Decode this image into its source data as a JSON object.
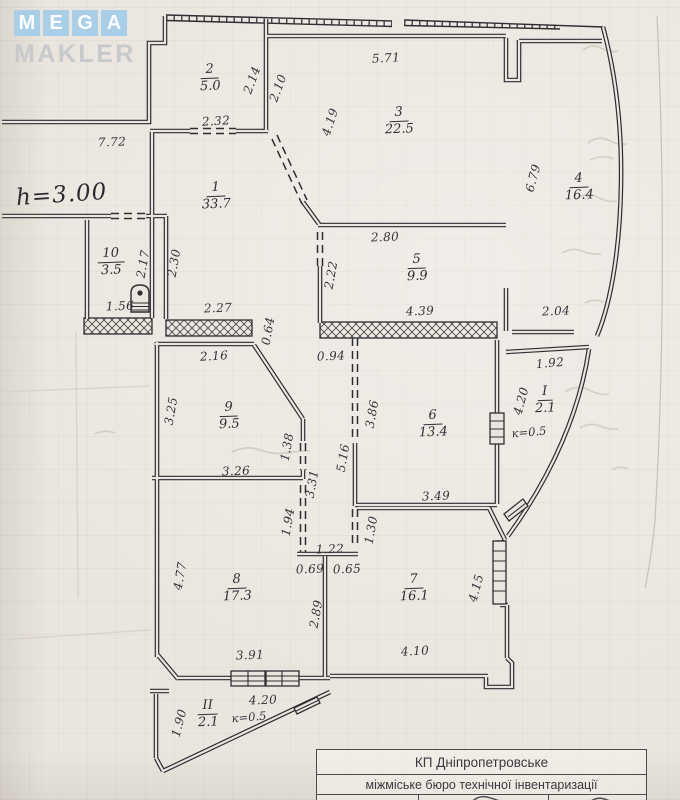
{
  "watermark": {
    "letters": [
      "M",
      "E",
      "G",
      "A"
    ],
    "subtitle": "MAKLER"
  },
  "notes": {
    "ceiling_height": "h=3.00"
  },
  "rooms": [
    {
      "number": "1",
      "area": "33.7"
    },
    {
      "number": "2",
      "area": "5.0"
    },
    {
      "number": "3",
      "area": "22.5"
    },
    {
      "number": "4",
      "area": "16.4"
    },
    {
      "number": "5",
      "area": "9.9"
    },
    {
      "number": "6",
      "area": "13.4"
    },
    {
      "number": "7",
      "area": "16.1"
    },
    {
      "number": "8",
      "area": "17.3"
    },
    {
      "number": "9",
      "area": "9.5"
    },
    {
      "number": "10",
      "area": "3.5"
    },
    {
      "number": "І",
      "area": "2.1",
      "coef": "к=0.5"
    },
    {
      "number": "ІІ",
      "area": "2.1",
      "coef": "к=0.5"
    }
  ],
  "dims": [
    "7.72",
    "2.14",
    "2.10",
    "5.71",
    "4.19",
    "2.32",
    "6.79",
    "2.80",
    "2.22",
    "2.17",
    "2.30",
    "1.56",
    "2.27",
    "0.64",
    "4.39",
    "2.04",
    "2.16",
    "0.94",
    "1.92",
    "3.25",
    "3.86",
    "5.16",
    "4.20",
    "1.38",
    "3.31",
    "3.26",
    "3.49",
    "1.94",
    "1.30",
    "1.22",
    "0.69",
    "0.65",
    "4.77",
    "2.89",
    "4.15",
    "3.91",
    "4.10",
    "4.20",
    "1.90"
  ],
  "title_block": {
    "line1": "КП Дніпропетровське",
    "line2": "міжміське бюро технічної інвентаризації"
  },
  "colors": {
    "ink": "#2e2d33",
    "paper": "#eae6df",
    "logo_blue": "#a9cfe8"
  }
}
